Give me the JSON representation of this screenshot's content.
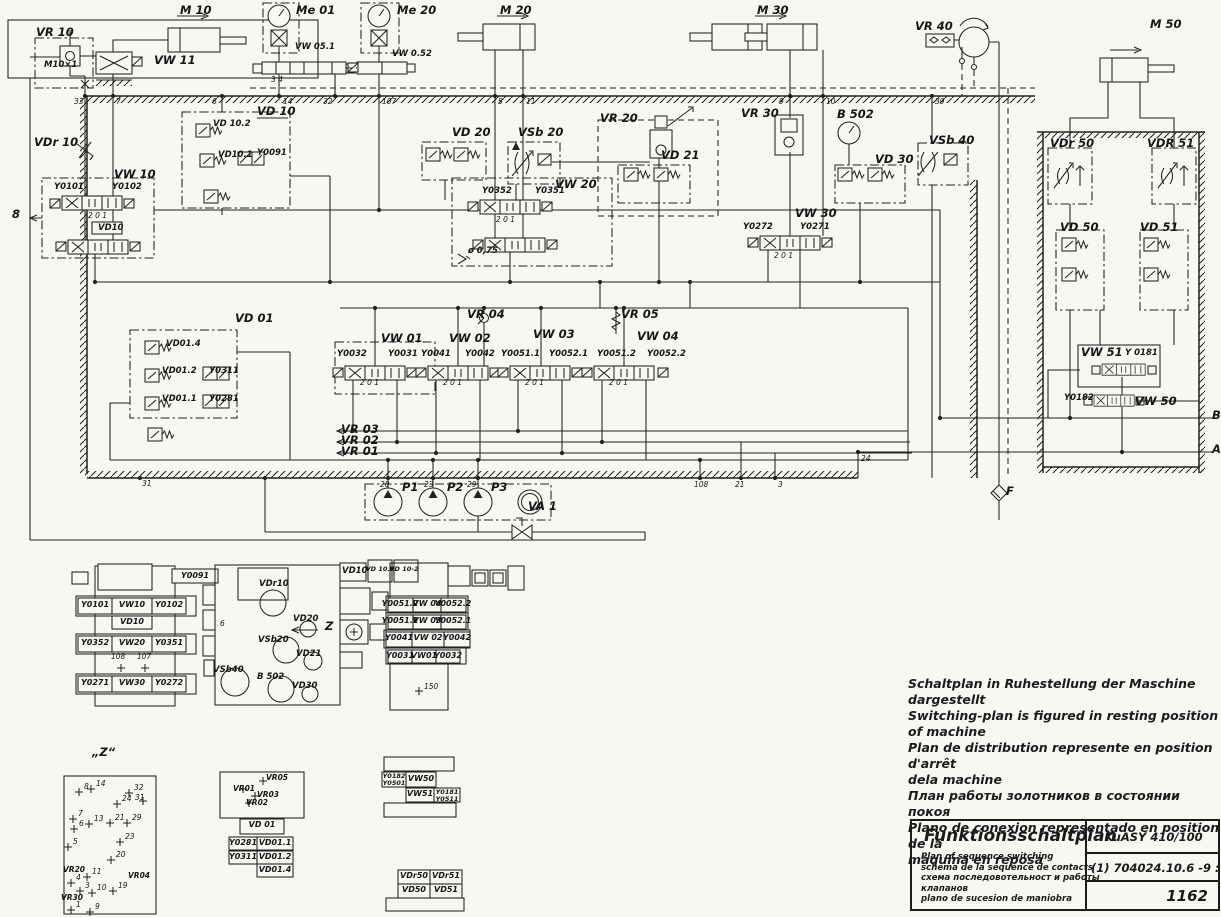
{
  "colors": {
    "ink": "#222222",
    "paper": "#f8f7f2"
  },
  "notes": [
    "Schaltplan in Ruhestellung der Maschine dargestellt",
    "Switching-plan is figured in resting position of machine",
    "Plan de distribution represente en position d'arrêt",
    "dela machine",
    "План работы золотников в состоянии покоя",
    "Plano de conexion representado en position de la",
    "maquina en reposa"
  ],
  "title_block": {
    "title": "Funktionsschaltplan",
    "sub_en": "Plan of sequence switching",
    "sub_fr": "schema de la sequence de contacts",
    "sub_ru1": "схема последовотельност и работы",
    "sub_ru2": "клапанов",
    "sub_es": "plano de sucesion de maniobra",
    "model": "KuASY 410/100",
    "drawing_number": "(1) 704024.10.6 -9 : 013",
    "sheet_number": "1162"
  },
  "labels": {
    "m10": "M 10",
    "me01": "Me 01",
    "me20": "Me 20",
    "m20": "M 20",
    "m30": "M 30",
    "vr40": "VR 40",
    "m50": "M 50",
    "vr10": "VR 10",
    "vw11": "VW 11",
    "vdr10": "VDr 10",
    "vw10": "VW 10",
    "vd10": "VD 10",
    "vd20": "VD 20",
    "vsb20": "VSb 20",
    "vr20": "VR 20",
    "vd21": "VD 21",
    "vr30": "VR 30",
    "b502": "B 502",
    "vd30": "VD 30",
    "vsb40": "VSb 40",
    "vdr50": "VDr 50",
    "vdr51": "VDR 51",
    "vw20": "VW 20",
    "vw30": "VW 30",
    "vd50": "VD 50",
    "vd51": "VD 51",
    "vd01": "VD 01",
    "vw01": "VW 01",
    "vw02": "VW 02",
    "vw03": "VW 03",
    "vw04": "VW 04",
    "vr04": "VR 04",
    "vr05": "VR 05",
    "vr03": "VR 03",
    "vr02": "VR 02",
    "vr01": "VR 01",
    "p1": "P1",
    "p2": "P2",
    "p3": "P3",
    "va1": "VA 1",
    "f_lbl": "F",
    "vw51_lbl": "VW 51",
    "vw50_lbl": "VW 50",
    "b_port": "B",
    "a_port": "A",
    "left8": "8",
    "z_lbl": "Z",
    "z_title": "„Z“",
    "m10x1": "M10×1",
    "vw051": "VW 05.1",
    "vw052": "VW 0.52",
    "vd10_2": "VD 10.2",
    "vd10_1": "VD10.1",
    "y0091": "Y0091",
    "y0101": "Y0101",
    "y0102": "Y0102",
    "vd10s": "VD10",
    "y0352": "Y0352",
    "y0351": "Y0351",
    "phi075": "ø 0,75",
    "y0272": "Y0272",
    "y0271": "Y0271",
    "vd01_4": "VD01.4",
    "vd01_2": "VD01.2",
    "y0311": "Y0311",
    "vd01_1": "VD01.1",
    "y0281": "Y0281",
    "y0032": "Y0032",
    "y0031": "Y0031",
    "y0041": "Y0041",
    "y0042": "Y0042",
    "y0051_1": "Y0051.1",
    "y0052_1": "Y0052.1",
    "y0051_2": "Y0051.2",
    "y0052_2": "Y0052.2",
    "y0181": "Y 0181",
    "y0182": "Y0182",
    "n33": "33",
    "n7": "7",
    "n6": "6",
    "n14": "14",
    "n32": "32",
    "n107": "107",
    "n5": "5",
    "n11": "11",
    "n9": "9",
    "n10": "10",
    "n39": "39",
    "n31": "31",
    "n20": "20",
    "n23": "23",
    "n29": "29",
    "n108": "108",
    "n21": "21",
    "n3": "3",
    "n24": "24",
    "pos_vw10": "2 0 1",
    "pos_vw20": "2 0 1",
    "pos_vw30": "2 0 1",
    "pos_vw01": "2 0 1",
    "pos_vw02": "2 0 1",
    "pos_vw03": "2 0 1",
    "pos_vw04": "2 0 1",
    "pos_vw051": "3 4",
    "mv1_y0091": "Y0091",
    "mv1_y0101": "Y0101",
    "mv1_vw10": "VW10",
    "mv1_y0102": "Y0102",
    "mv1_vd10": "VD10",
    "mv1_6": "6",
    "mv1_y0352": "Y0352",
    "mv1_vw20": "VW20",
    "mv1_y0351": "Y0351",
    "mv1_108": "108",
    "mv1_107": "107",
    "mv1_y0271": "Y0271",
    "mv1_vw30": "VW30",
    "mv1_y0272": "Y0272",
    "mv2_vd10": "VD10",
    "mv2_vd101": "VD 10.1",
    "mv2_vd102": "VD 10-2",
    "mv2_vdr10": "VDr10",
    "mv2_vd20": "VD20",
    "mv2_vsb20": "VSb20",
    "mv2_vd21": "VD21",
    "mv2_vsb40": "VSb40",
    "mv2_b502": "B 502",
    "mv2_vd30": "VD30",
    "mv3_y00512": "Y0051.2",
    "mv3_vw04": "VW 04",
    "mv3_y00522": "Y0052.2",
    "mv3_y00511": "Y0051.1",
    "mv3_vw03": "VW 03",
    "mv3_y00521": "Y0052.1",
    "mv3_y0041": "Y0041",
    "mv3_vw02": "VW 02",
    "mv3_y0042": "Y0042",
    "mv3_y0031": "Y0031",
    "mv3_vw01": "VW01",
    "mv3_y0032": "Y0032",
    "mv3_150": "150",
    "z1": "1",
    "z3": "3",
    "z4": "4",
    "z5": "5",
    "z6": "6",
    "z7": "7",
    "z8": "8",
    "z9": "9",
    "z10": "10",
    "z11": "11",
    "z13": "13",
    "z14": "14",
    "z19": "19",
    "z20": "20",
    "z21": "21",
    "z23": "23",
    "z24": "24",
    "z29": "29",
    "z31": "31",
    "z32": "32",
    "zvr20": "VR20",
    "zvr04": "VR04",
    "zvr30": "VR30",
    "mvr_vr01": "VR01",
    "mvr_vr02": "VR02",
    "mvr_vr03": "VR03",
    "mvr_vr05": "VR05",
    "mvr_vd01": "VD 01",
    "mvr_y0281": "Y0281",
    "mvr_vd011": "VD01.1",
    "mvr_y0311": "Y0311",
    "mvr_vd012": "VD01.2",
    "mvr_vd014": "VD01.4",
    "mv5_y0182": "Y0182",
    "mv5_y0501": "Y0501",
    "mv5_vw50": "VW50",
    "mv5_vw51": "VW51",
    "mv5_y0181": "Y0181",
    "mv5_y0511": "Y0511",
    "mv6_vdr50": "VDr50",
    "mv6_vdr51": "VDr51",
    "mv6_vd50": "VD50",
    "mv6_vd51": "VD51"
  }
}
